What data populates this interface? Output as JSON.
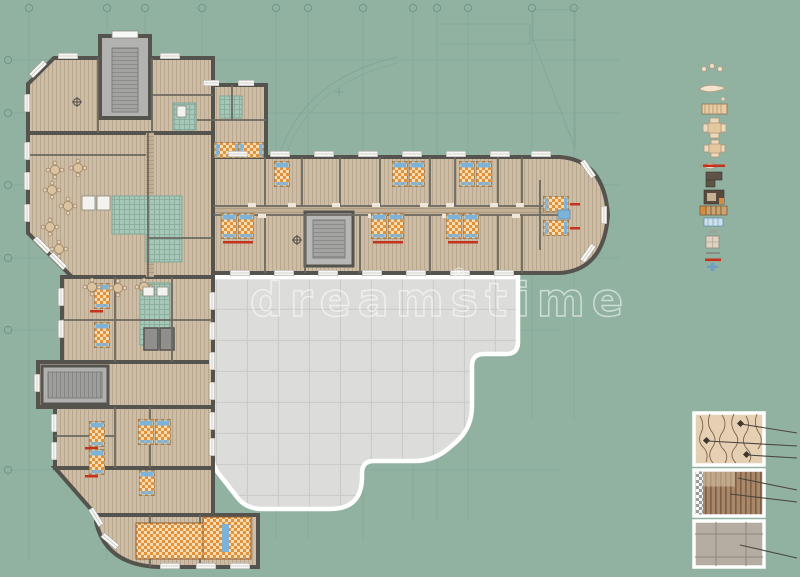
{
  "title": "Apartment hotel floor plan drawing",
  "watermark": {
    "text": "dreamstime",
    "registered_mark": "®"
  },
  "palette": {
    "background": "#91b2a1",
    "construction_line": "#6f9486",
    "wall": "#55534e",
    "wood_floor": "#cdbca6",
    "wood_stripe": "#b9a78e",
    "corridor_floor": "#bfae95",
    "tile_green": "#a7c8b9",
    "stair_gray": "#b2b2b0",
    "terrace_gray": "#dcdcda",
    "terrace_grid": "#c9c9c7",
    "window_white": "#f7f7f5",
    "bed_orange": "#e1913c",
    "bed_cream": "#f7ddb1",
    "pillow_blue": "#7db3d9",
    "accent_red": "#c5331f",
    "furniture_dark": "#5f5246",
    "callout_line": "#4a463e"
  },
  "axis_grid": {
    "top_bubbles": 12,
    "left_bubbles": 6
  },
  "legend_symbols": [
    {
      "name": "stools"
    },
    {
      "name": "bathtub"
    },
    {
      "name": "single-bed"
    },
    {
      "name": "table-with-chairs-large"
    },
    {
      "name": "table-with-chairs-small"
    },
    {
      "name": "sofa-with-red-accent"
    },
    {
      "name": "corner-sofa"
    },
    {
      "name": "wardrobe"
    },
    {
      "name": "striped-chest"
    },
    {
      "name": "glazed-partition"
    },
    {
      "name": "door-leaf"
    },
    {
      "name": "side-table"
    },
    {
      "name": "wall-segment"
    },
    {
      "name": "red-marker"
    },
    {
      "name": "plumbing-fixture"
    }
  ],
  "material_callouts": [
    {
      "name": "parquet-floor-detail",
      "leader_count": 3
    },
    {
      "name": "plank-floor-detail",
      "leader_count": 2
    },
    {
      "name": "screed-floor-detail",
      "leader_count": 1
    }
  ]
}
